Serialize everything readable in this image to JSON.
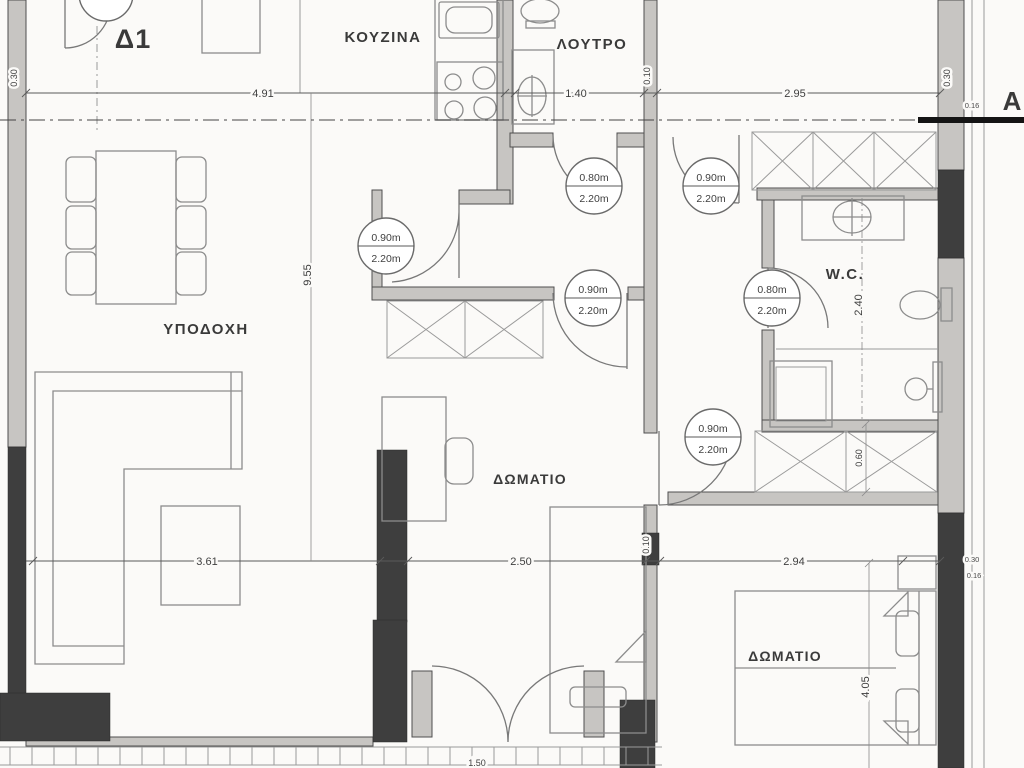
{
  "title": {
    "apartment": "Δ1",
    "section_marker": "A"
  },
  "rooms": {
    "kitchen": "ΚΟΥΖΙΝΑ",
    "bathroom": "ΛΟΥΤΡΟ",
    "reception": "ΥΠΟΔΟΧΗ",
    "bedroom1": "ΔΩΜΑΤΙΟ",
    "wc": "W.C.",
    "bedroom2": "ΔΩΜΑΤΙΟ"
  },
  "doors": [
    {
      "id": "hall-door",
      "width": "0.90m",
      "height": "2.20m"
    },
    {
      "id": "bathroom-door",
      "width": "0.80m",
      "height": "2.20m"
    },
    {
      "id": "top-right-door",
      "width": "0.90m",
      "height": "2.20m"
    },
    {
      "id": "bedroom1-door",
      "width": "0.90m",
      "height": "2.20m"
    },
    {
      "id": "wc-door",
      "width": "0.80m",
      "height": "2.20m"
    },
    {
      "id": "bedroom2-door",
      "width": "0.90m",
      "height": "2.20m"
    }
  ],
  "dims": {
    "wall_left": "0.30",
    "kitchen_width": "4.91",
    "bathroom_width": "1.40",
    "wall_bath": "0.10",
    "top_right_width": "2.95",
    "wall_right": "0.30",
    "wall_right_offset": "0.16",
    "plan_depth": "9.55",
    "wc_depth": "2.40",
    "closet_depth": "0.60",
    "living_width": "3.61",
    "bedroom1_width": "2.50",
    "wall_bedroom1": "0.10",
    "bedroom2_width": "2.94",
    "bedroom2_wall": "0.30",
    "bedroom2_wall_offset": "0.16",
    "bedroom2_depth": "4.05",
    "balcony_door_width": "1.50"
  },
  "colors": {
    "background": "#fbfaf8",
    "wall_dark": "#3e3e3e",
    "wall_light": "#c7c5c2",
    "furniture_line": "#8c8c8c",
    "dimension_line": "#5a5a5a",
    "text": "#3a3a3a",
    "section_line": "#141414"
  }
}
